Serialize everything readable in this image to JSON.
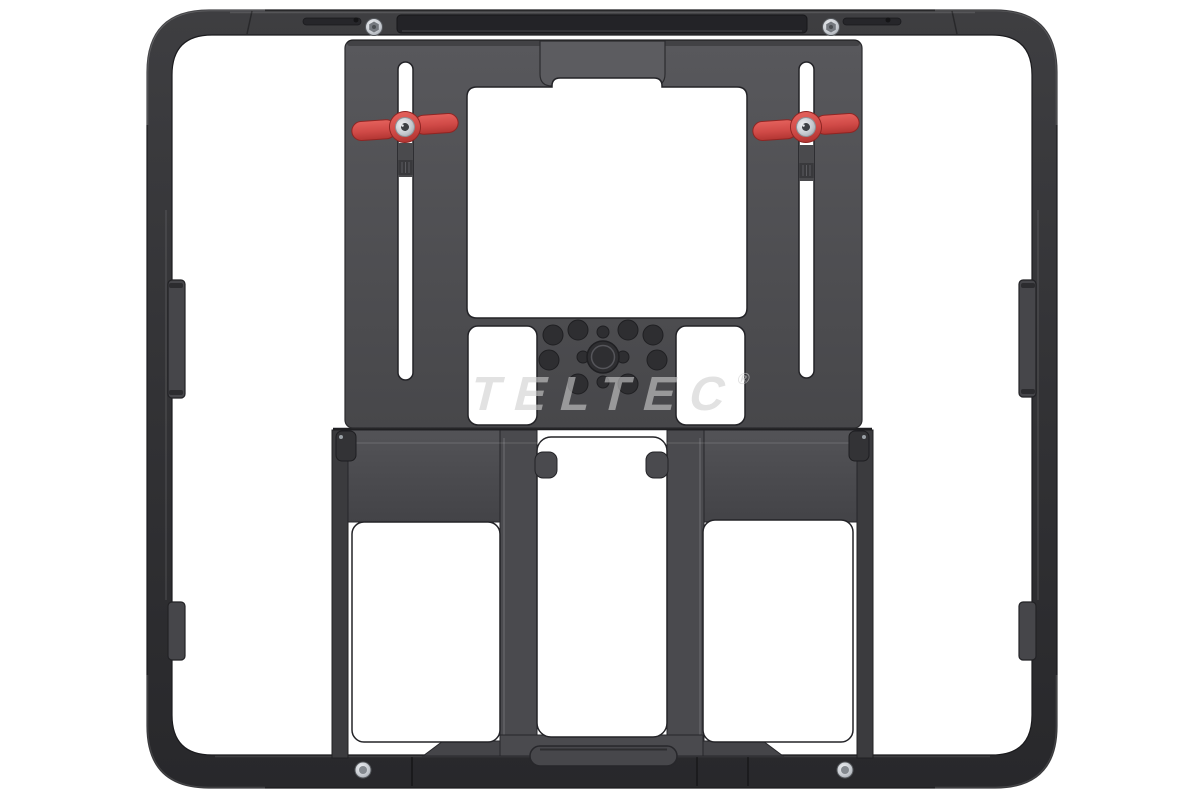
{
  "scene": {
    "type": "product-photo",
    "subject": "Aluminium tablet cage rig with fold-out kickstand, dual red locking thumb levers and a central threaded mounting hub, photographed on a white background",
    "background": "#ffffff"
  },
  "watermark": {
    "text": "TELTEC",
    "registered_mark": "®",
    "color": "#cfcfcf"
  },
  "colors": {
    "frame_dark": "#313134",
    "plate_gray": "#4f4f52",
    "accent_red": "#d6504c",
    "screw_silver": "#c9cdd2",
    "hole_dark": "#2e2e31",
    "cutout_outline": "#232327"
  },
  "parts": {
    "outer_frame": "cage frame",
    "top_rail_bar": "accessory mounting bar",
    "locking_lever": "red locking thumb lever",
    "adjustment_slot": "height adjustment slot",
    "mounting_hub": "threaded mounting hub",
    "kickstand": "fold-out kickstand",
    "port_cover": "side port cover tab",
    "screw": "fastening screw"
  }
}
